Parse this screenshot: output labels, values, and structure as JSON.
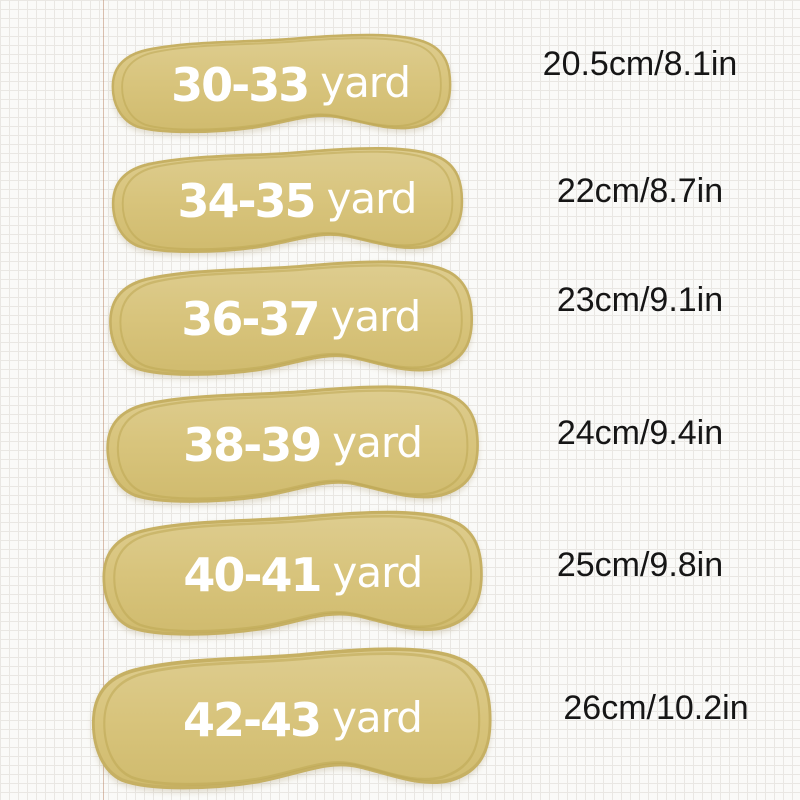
{
  "image_type": "insole size chart",
  "unit_label": "yard",
  "rows": [
    {
      "size": "30-33",
      "unit": "yard",
      "measurement": "20.5cm/8.1in"
    },
    {
      "size": "34-35",
      "unit": "yard",
      "measurement": "22cm/8.7in"
    },
    {
      "size": "36-37",
      "unit": "yard",
      "measurement": "23cm/9.1in"
    },
    {
      "size": "38-39",
      "unit": "yard",
      "measurement": "24cm/9.4in"
    },
    {
      "size": "40-41",
      "unit": "yard",
      "measurement": "25cm/9.8in"
    },
    {
      "size": "42-43",
      "unit": "yard",
      "measurement": "26cm/10.2in"
    }
  ],
  "colors": {
    "insole_fill": "#d8c47c",
    "insole_edge": "#c6b063",
    "label_text": "#ffffff",
    "measurement_text": "#161616",
    "paper_background": "#fafaf8",
    "paper_grid_line": "#e9e7e3",
    "paper_margin_line": "#be8c70"
  }
}
